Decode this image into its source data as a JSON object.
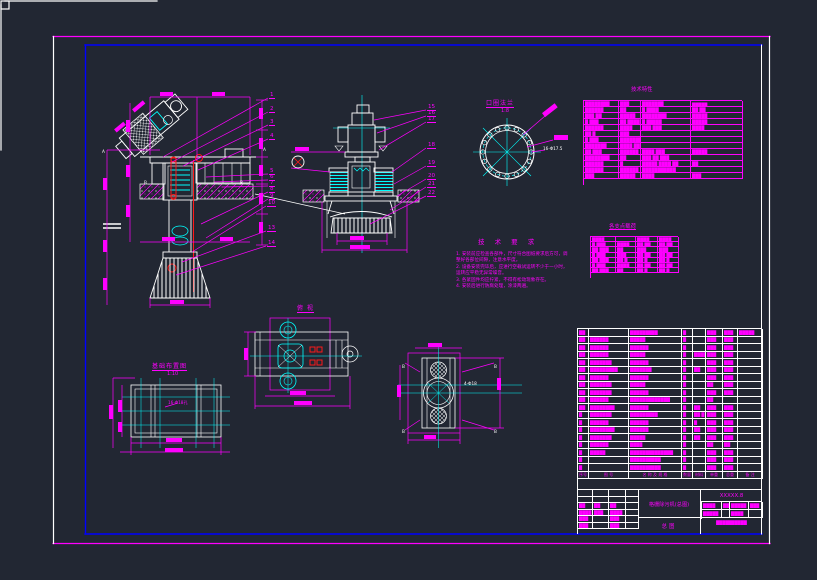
{
  "colors": {
    "bg": "#222733",
    "magenta": "#ff00ff",
    "cyan": "#00ffff",
    "white": "#ffffff",
    "red": "#ff1a1a",
    "blue": "#0000ff"
  },
  "views": {
    "flange": {
      "title": "口圈法兰",
      "scale": "1:8",
      "hole_label": "16-Φ17.5"
    },
    "plan": {
      "title": "俯 视"
    },
    "section": {
      "letter": "B",
      "hole_label": "4-Φ18"
    },
    "side": {
      "cut_letter_a": "A",
      "cut_letter_b": "B"
    },
    "foundation": {
      "title": "基础布置图",
      "scale": "1:10",
      "hole_label": "16-Φ18孔"
    }
  },
  "notes": {
    "title": "技 术 要 求",
    "lines": [
      {
        "num": "1.",
        "text": "安装前应检查各部件，尺寸符合图纸要求后方可，调"
      },
      {
        "num": "",
        "text": "整好各部位间隙，注意水平度。"
      },
      {
        "num": "2.",
        "text": "设备安装完毕后，应进行空载试运转不少于一小时，"
      },
      {
        "num": "",
        "text": "运转应平稳无异常噪音。"
      },
      {
        "num": "3.",
        "text": "各紧固件均应拧紧，不得有松动现象存在。"
      },
      {
        "num": "4.",
        "text": "安装后进行防腐处理，涂漆两遍。"
      }
    ]
  },
  "tech_table": {
    "title": "技术特性",
    "rows": [
      [
        "████████",
        "███",
        "███████",
        "▆▆▆▆▆"
      ],
      [
        "██████",
        "██",
        "█ ████",
        "██ ██"
      ],
      [
        "███ ██",
        "█████",
        "████████",
        "█████"
      ],
      [
        "█ ███",
        "██ ████",
        "█ █████",
        "█████"
      ],
      [
        "██████",
        "████",
        "███ ███",
        "████"
      ],
      [
        "██ █",
        "███",
        ",",
        ""
      ],
      [
        "█ ███",
        "█████████████",
        "",
        " "
      ],
      [
        "███████",
        "████ ██████",
        "",
        ""
      ],
      [
        "██ ███",
        "██████",
        "████ ███",
        "█████"
      ],
      [
        "████████",
        "██",
        "███ ██ ███",
        ""
      ],
      [
        "██████",
        "█",
        "█████ ████ ██",
        "██"
      ],
      [
        "██████",
        "██████",
        "███████████",
        ""
      ],
      [
        "███",
        "█████",
        "████",
        "███"
      ]
    ]
  },
  "load_table": {
    "title": "各支点载荷",
    "rows": [
      [
        "████",
        "",
        "████",
        "████"
      ],
      [
        "█ ███",
        "████",
        "██ ██",
        "██ ██"
      ],
      [
        "██ ███",
        "██",
        "███",
        "███"
      ],
      [
        "█ ███",
        "███",
        "██ ██",
        "██ ██"
      ],
      [
        "██ ███",
        "██ █",
        "██ █",
        "██ █"
      ],
      [
        "█ ███",
        "████",
        "██ ██",
        "██ ██"
      ],
      [
        "██ ███",
        "██",
        "██ █",
        "██ █"
      ]
    ]
  },
  "parts_list": {
    "headers": [
      "序号",
      "图  号",
      "名 称 及 规 格",
      "数量",
      "材料",
      "单重",
      "总重",
      "备 注"
    ],
    "rows": [
      [
        "██",
        "",
        "█████████",
        "█",
        "",
        "███",
        "███",
        "█████"
      ],
      [
        "██",
        "██████",
        "█████",
        "█",
        "",
        "███",
        "███",
        ""
      ],
      [
        "██",
        "██████",
        "██████",
        "█",
        "",
        "███",
        "███",
        ""
      ],
      [
        "██",
        "██████",
        "█████",
        "█",
        "████",
        "███",
        "███",
        ""
      ],
      [
        "██",
        "███████",
        "██████",
        "█",
        "",
        "███",
        "███",
        ""
      ],
      [
        "██",
        "█████████",
        "███████",
        "█",
        "██",
        "███",
        "███",
        ""
      ],
      [
        "██",
        "██████",
        "██████",
        "█",
        "",
        "███",
        "███",
        ""
      ],
      [
        "██",
        "███████",
        "█████",
        "█",
        "",
        "██",
        "███",
        ""
      ],
      [
        "██",
        "███████",
        "██████",
        "█",
        "",
        "███",
        "███",
        ""
      ],
      [
        "██",
        "██████",
        "█████████████",
        "█",
        "",
        "██",
        "",
        ""
      ],
      [
        "██",
        "████████",
        "██████",
        "█",
        "██",
        "███",
        "███",
        ""
      ],
      [
        "█",
        "███████",
        "█████████",
        "█",
        "██ █",
        "███",
        "███",
        ""
      ],
      [
        "█",
        "██████",
        "██████",
        "█",
        "█",
        "███",
        "███",
        ""
      ],
      [
        "█",
        "████████",
        "██████",
        "█",
        "██",
        "███",
        "███",
        ""
      ],
      [
        "█",
        "███████",
        "█████",
        "█",
        "██",
        "███",
        "███",
        ""
      ],
      [
        "█",
        "██████",
        "████",
        "█",
        "",
        "██",
        "██",
        ""
      ],
      [
        "█",
        "█████",
        "██████████████",
        "█",
        "",
        "███",
        "███",
        ""
      ],
      [
        "█",
        "",
        "██████████",
        "█",
        "",
        "███",
        "███",
        ""
      ],
      [
        "█",
        "",
        "██████████",
        "█",
        "",
        "███",
        "███",
        ""
      ]
    ]
  },
  "title_block": {
    "sig_rows": [
      [
        "",
        "",
        "",
        ""
      ],
      [
        "",
        "",
        "",
        ""
      ],
      [
        "██",
        "██",
        "██",
        ""
      ],
      [
        "████",
        "███",
        "████",
        ""
      ],
      [
        "███",
        "",
        "███",
        ""
      ],
      [
        "███",
        "",
        "███",
        ""
      ]
    ],
    "main_title": "格栅除污机(总图)",
    "sub_title": "总图",
    "code": "XXXXX.8",
    "info_rows": [
      [
        "████",
        "██",
        "█████",
        "███"
      ],
      [
        "█████",
        "",
        "████",
        ""
      ]
    ],
    "info_bottom": "██████████"
  },
  "balloons": {
    "left": [
      {
        "n": "1",
        "x": 269,
        "y": 92,
        "tx": 163,
        "ty": 157
      },
      {
        "n": "2",
        "x": 269,
        "y": 106,
        "tx": 172,
        "ty": 162
      },
      {
        "n": "3",
        "x": 269,
        "y": 119,
        "tx": 183,
        "ty": 166
      },
      {
        "n": "4",
        "x": 269,
        "y": 133,
        "tx": 198,
        "ty": 170
      },
      {
        "n": "5",
        "x": 269,
        "y": 168,
        "tx": 206,
        "ty": 177
      },
      {
        "n": "6",
        "x": 269,
        "y": 174,
        "tx": 214,
        "ty": 182
      },
      {
        "n": "7",
        "x": 269,
        "y": 180,
        "tx": 222,
        "ty": 187
      },
      {
        "n": "8",
        "x": 269,
        "y": 186,
        "tx": 201,
        "ty": 224
      },
      {
        "n": "9",
        "x": 269,
        "y": 193,
        "tx": 206,
        "ty": 238
      },
      {
        "n": "10",
        "x": 267,
        "y": 200,
        "tx": 192,
        "ty": 252
      },
      {
        "n": "13",
        "x": 267,
        "y": 225,
        "tx": 182,
        "ty": 262
      },
      {
        "n": "14",
        "x": 267,
        "y": 240,
        "tx": 176,
        "ty": 275
      }
    ],
    "right": [
      {
        "n": "15",
        "x": 427,
        "y": 104,
        "tx": 374,
        "ty": 120
      },
      {
        "n": "16",
        "x": 427,
        "y": 110,
        "tx": 377,
        "ty": 133
      },
      {
        "n": "17",
        "x": 427,
        "y": 116,
        "tx": 379,
        "ty": 150
      },
      {
        "n": "18",
        "x": 427,
        "y": 142,
        "tx": 392,
        "ty": 172
      },
      {
        "n": "19",
        "x": 427,
        "y": 160,
        "tx": 394,
        "ty": 184
      },
      {
        "n": "20",
        "x": 427,
        "y": 173,
        "tx": 397,
        "ty": 196
      },
      {
        "n": "21",
        "x": 427,
        "y": 181,
        "tx": 390,
        "ty": 210
      },
      {
        "n": "22",
        "x": 427,
        "y": 190,
        "tx": 370,
        "ty": 224
      }
    ]
  }
}
